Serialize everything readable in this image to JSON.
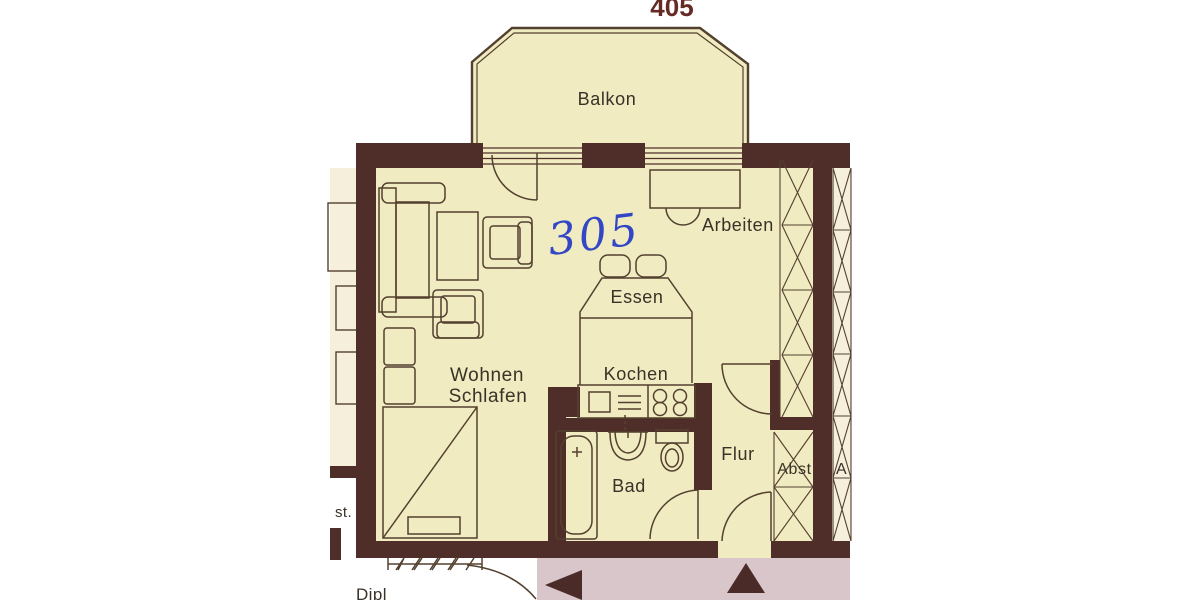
{
  "unit": {
    "current": "305",
    "above": "405"
  },
  "rooms": {
    "balkon": "Balkon",
    "arbeiten": "Arbeiten",
    "essen": "Essen",
    "kochen": "Kochen",
    "wohnen_line1": "Wohnen",
    "wohnen_line2": "Schlafen",
    "bad": "Bad",
    "flur": "Flur",
    "abst": "Abst."
  },
  "fragments": {
    "left_edge_text": "st.",
    "right_edge_text": "A",
    "bottom_left_text": "Dipl"
  },
  "colors": {
    "wall": "#4f2e29",
    "line": "#53402f",
    "room_fill": "#f0ebc0",
    "neighbor_fill": "#f5efdc",
    "label": "#3a3128",
    "handwriting": "#3346c5",
    "unit_above": "#652a24",
    "stair_pink": "#d9c6cb",
    "arrow": "#4b2b27"
  }
}
